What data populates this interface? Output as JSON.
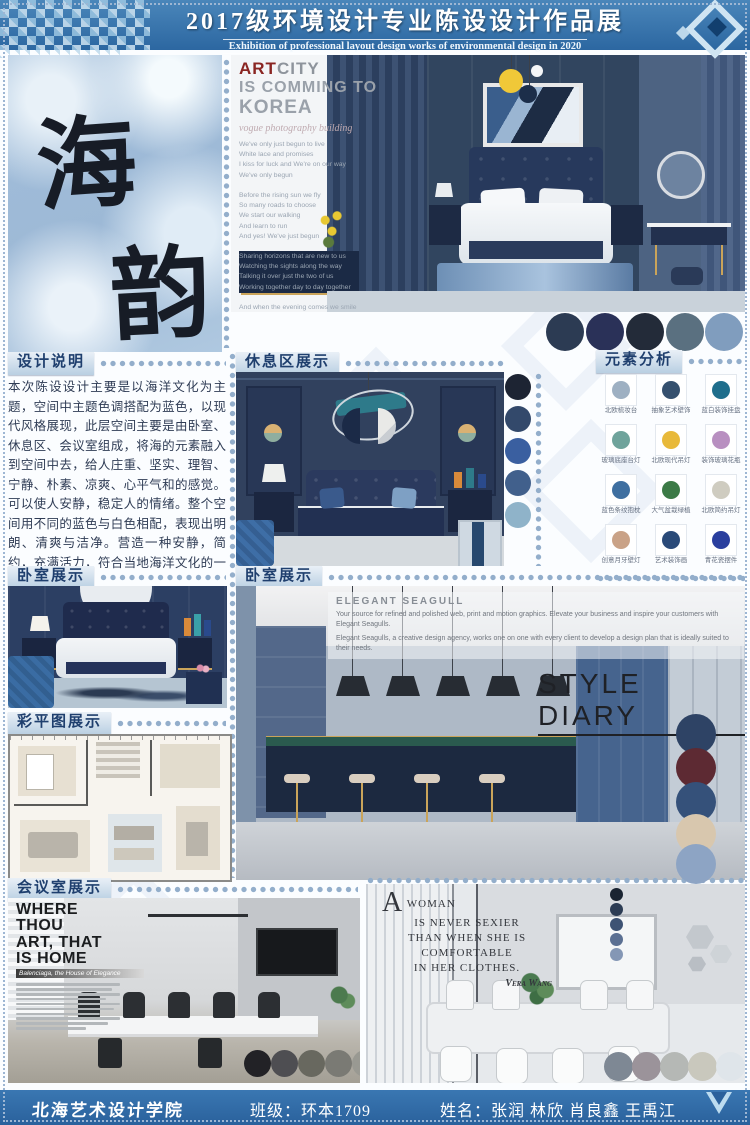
{
  "header": {
    "title": "2017级环境设计专业陈设设计作品展",
    "subtitle": "Exhibition of professional layout design works of environmental design in 2020"
  },
  "colors": {
    "band_blue": "#336fa8",
    "footer_blue": "#2e6ba6",
    "dot_blue": "#93aecb"
  },
  "art_panel": {
    "char1": "海",
    "char2": "韵"
  },
  "hero": {
    "art_accent": "ART",
    "art_rest": "CITY",
    "line2": "IS COMMING TO",
    "line3": "KOREA",
    "tagline": "vogue photography building",
    "lyrics": "We've only just begun to live\nWhite lace and promises\nI kiss for luck and We're on our way\nWe've only begun\n\nBefore the rising sun we fly\nSo many roads to choose\nWe start our walking\nAnd learn to run\nAnd yes! We've just begun\n\nSharing horizons that are new to us\nWatching the sights along the way\nTalking it over just the two of us\nWorking together day to day together\n\nAnd when the evening comes we smile\nSo much of life ahead\nWe'll find a place where there's room to grow\nAnd yes! We've just begun",
    "palette": [
      "#2c3b53",
      "#2a3158",
      "#232b39",
      "#5a7080",
      "#809dbe"
    ]
  },
  "design_notes": {
    "heading": "设计说明",
    "body": "本次陈设设计主要是以海洋文化为主题，空间中主题色调搭配为蓝色，以现代风格展现，此层空间主要是由卧室、休息区、会议室组成，将海的元素融入到空间中去，给人庄重、坚实、理智、宁静、朴素、凉爽、心平气和的感觉。可以使人安静，稳定人的情绪。整个空间用不同的蓝色与白色相配，表现出明朗、清爽与洁净。营造一种安静，简约，充满活力，符合当地海洋文化的一个空间。"
  },
  "sections": {
    "lounge": "休息区展示",
    "elements": "元素分析",
    "bedroom": "卧室展示",
    "bedroom2": "卧室展示",
    "floorplan": "彩平图展示",
    "meeting": "会议室展示"
  },
  "elements": {
    "items": [
      {
        "label": "北欧梳妆台",
        "color": "#9eb0c2"
      },
      {
        "label": "抽象艺术壁饰",
        "color": "#35506e"
      },
      {
        "label": "蓝白装饰挂盘",
        "color": "#1f6e8c"
      },
      {
        "label": "玻璃底座台灯",
        "color": "#6fa39b"
      },
      {
        "label": "北欧现代吊灯",
        "color": "#e8b93a"
      },
      {
        "label": "装饰玻璃花瓶",
        "color": "#b88fc0"
      },
      {
        "label": "蓝色条纹抱枕",
        "color": "#3f6fa0"
      },
      {
        "label": "大气盆栽绿植",
        "color": "#3c7a46"
      },
      {
        "label": "北欧简约吊灯",
        "color": "#cfccc0"
      },
      {
        "label": "创意月牙壁灯",
        "color": "#c9a287"
      },
      {
        "label": "艺术装饰画",
        "color": "#2a4a78"
      },
      {
        "label": "青花瓷摆件",
        "color": "#2a3f9e"
      }
    ]
  },
  "lounge": {
    "palette": [
      "#1d2433",
      "#33496b",
      "#3a5fa0",
      "#41608c",
      "#8fb3c9"
    ]
  },
  "style_diary": {
    "brand": "ELEGANT SEAGULL",
    "p1": "Your source for refined and polished web, print and motion graphics. Elevate your business and inspire your customers with Elegant Seagulls.",
    "p2": "Elegant Seagulls, a creative design agency, works one on one with every client to develop a design plan that is ideally suited to their needs.",
    "title": "STYLE DIARY",
    "palette": [
      "#2e4365",
      "#5d2a33",
      "#35517a",
      "#d8c7ae",
      "#8da4c4"
    ]
  },
  "meeting_left": {
    "l1": "WHERE",
    "l2": "THOU",
    "l3": "ART, THAT",
    "l4": "IS HOME",
    "subtitle": "Balenciaga, the House of Elegance",
    "palette": [
      "#222226",
      "#4e4e52",
      "#68685f",
      "#7a7a74",
      "#999992"
    ]
  },
  "meeting_right": {
    "dropcap": "A",
    "l1": "WOMAN",
    "l2": "IS NEVER SEXIER",
    "l3": "THAN WHEN SHE IS",
    "l4": "COMFORTABLE",
    "l5": "IN HER CLOTHES.",
    "author": "Vera Wang",
    "dots": [
      "#1a2432",
      "#2c3c54",
      "#3e5374",
      "#5a6f92",
      "#8497b5"
    ],
    "palette": [
      "#7e8894",
      "#9b939a",
      "#b5b8b5",
      "#c9c8bd",
      "#dfe5ea"
    ]
  },
  "footer": {
    "school": "北海艺术设计学院",
    "class_info": "班级：环本1709",
    "names_info": "姓名：张润 林欣 肖良鑫 王禹江"
  }
}
